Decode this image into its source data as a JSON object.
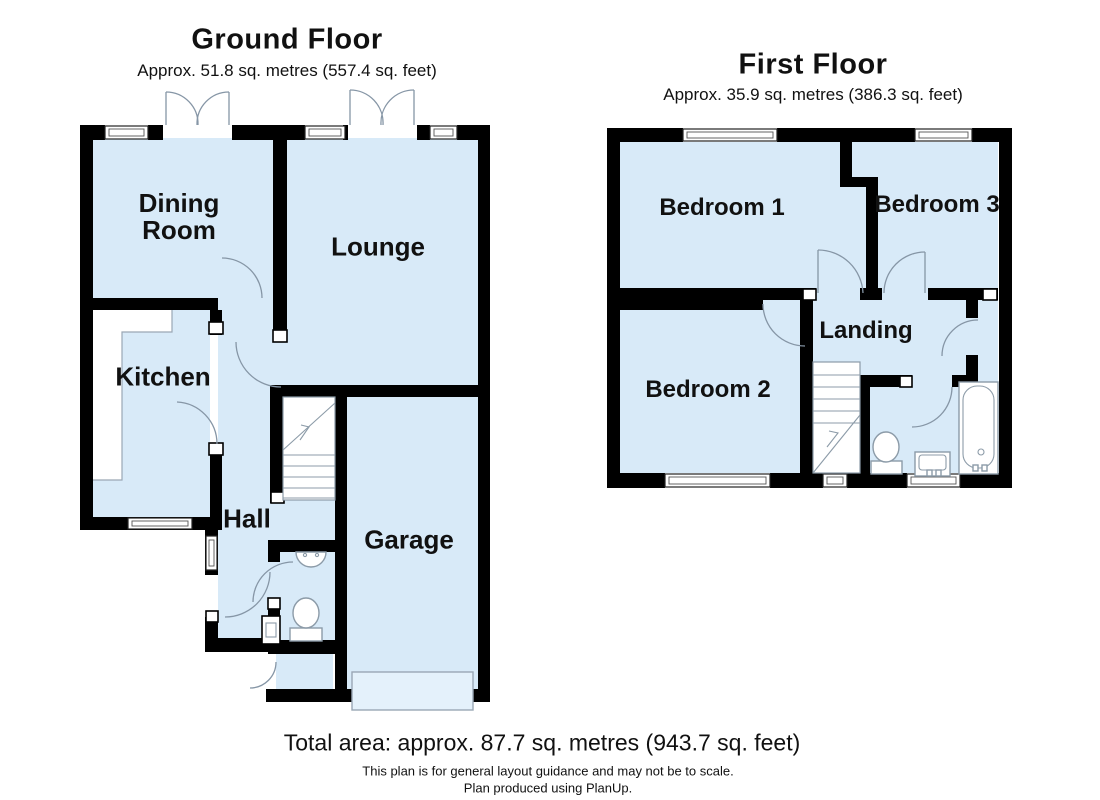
{
  "ground_floor": {
    "title": "Ground Floor",
    "subtitle": "Approx. 51.8 sq. metres (557.4 sq. feet)",
    "rooms": {
      "dining_room": "Dining\nRoom",
      "lounge": "Lounge",
      "kitchen": "Kitchen",
      "hall": "Hall",
      "garage": "Garage"
    }
  },
  "first_floor": {
    "title": "First Floor",
    "subtitle": "Approx. 35.9 sq. metres (386.3 sq. feet)",
    "rooms": {
      "bedroom1": "Bedroom 1",
      "bedroom2": "Bedroom 2",
      "bedroom3": "Bedroom 3",
      "landing": "Landing"
    }
  },
  "footer": {
    "total_area": "Total area: approx. 87.7 sq. metres (943.7 sq. feet)",
    "disclaimer_line1": "This plan is for general layout guidance and may not be to scale.",
    "disclaimer_line2": "Plan produced using PlanUp."
  },
  "colors": {
    "wall": "#000000",
    "room_fill": "#D8EAF8",
    "background": "#FFFFFF",
    "fixture_outline": "#8C9BA8"
  }
}
